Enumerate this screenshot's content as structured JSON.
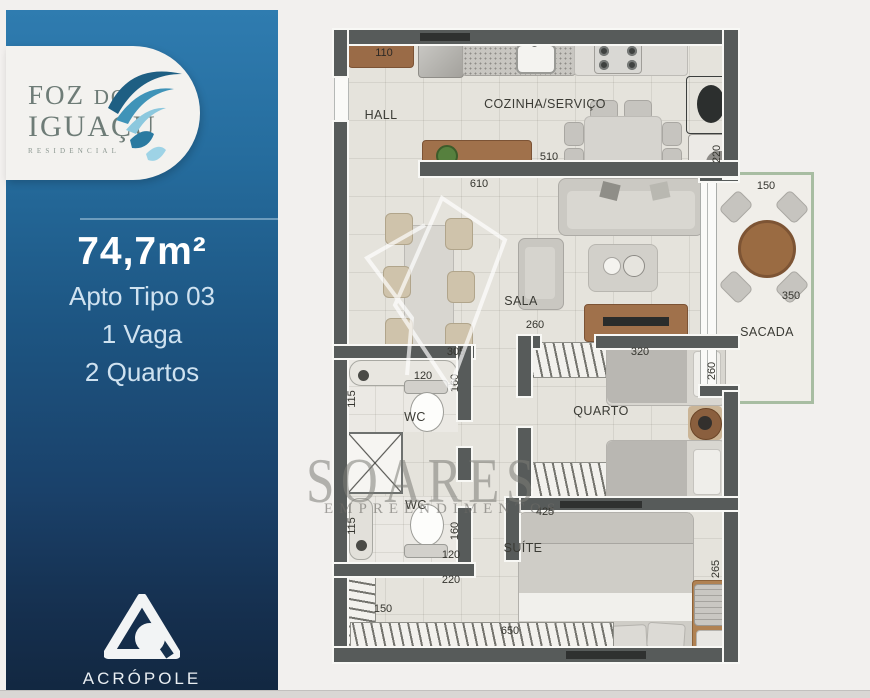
{
  "sidebar": {
    "logo": {
      "foz": "FOZ",
      "do": "DO",
      "iguacu": "IGUAÇU",
      "residencial": "RESIDENCIAL"
    },
    "area": "74,7m²",
    "tipo": "Apto Tipo 03",
    "vaga": "1 Vaga",
    "quartos": "2 Quartos",
    "builder": "ACRÓPOLE"
  },
  "watermark": {
    "brand": "SOARES",
    "subtitle": "EMPREENDIMENTOS"
  },
  "plan": {
    "rooms": {
      "hall": "HALL",
      "kitchen": "COZINHA/SERVIÇO",
      "sala": "SALA",
      "sacada": "SACADA",
      "quarto": "QUARTO",
      "wc1": "WC",
      "wc2": "WC",
      "suite": "SUÍTE"
    },
    "dims": {
      "hall_shelf": "110",
      "kitchen_width": "510",
      "kitchen_right": "220",
      "sala_width": "610",
      "sacada_width": "150",
      "sacada_depth": "350",
      "quarto_depth": "260",
      "sala_door": "260",
      "sala_bottom": "305",
      "quarto_width": "320",
      "wc1_top": "120",
      "wc1_right": "160",
      "wc1_left": "115",
      "wc2_left": "115",
      "wc2_right": "160",
      "wc2_bottom": "120",
      "suite_top": "425",
      "suite_right": "265",
      "closet_left": "150",
      "closet_mid": "220",
      "closet_bottom": "650"
    }
  },
  "colors": {
    "sidebar_top": "#2F7CB0",
    "sidebar_bottom": "#122740",
    "wall": "#575B5A",
    "wood": "#A5734C",
    "sacada_frame": "#A8BDA2",
    "splash_dark": "#1E5F83",
    "splash_light": "#8CC8DE"
  }
}
